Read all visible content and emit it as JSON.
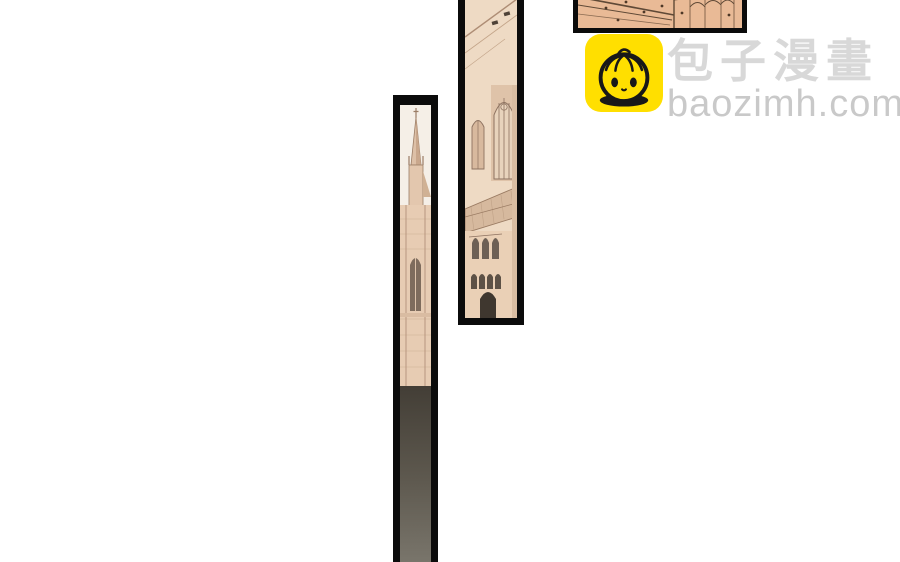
{
  "watermark": {
    "brand_name": "包子漫畫",
    "site_url": "baozimh.com",
    "logo_icon": "baozi-bun-mascot-icon"
  },
  "colors": {
    "page-bg": "#ffffff",
    "panel-border": "#0b0b0b",
    "logo-bg": "#ffdf00",
    "logo-ink": "#181818",
    "brand-text": "#d8d8d8",
    "url-text": "#c9c9c9",
    "art-sky": "#f5efe7",
    "art-wall": "#e7ccb3",
    "art-roof": "#d6b99e",
    "art-line": "#9b7d66",
    "art-dark-window": "#6e6055",
    "art-shadow-dark": "#474238",
    "art-wall-warm": "#e9ba96"
  },
  "panels": [
    {
      "id": "top-right",
      "art": "sepia-building-wall-artwork"
    },
    {
      "id": "middle",
      "art": "sepia-cathedral-tower-artwork"
    },
    {
      "id": "left",
      "art": "sepia-cathedral-spire-artwork"
    }
  ]
}
